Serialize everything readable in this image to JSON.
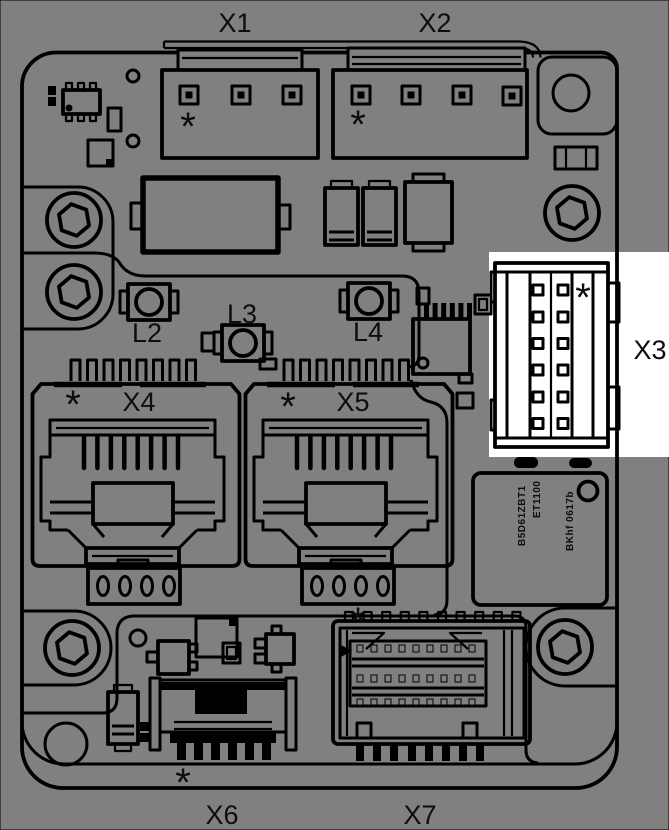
{
  "colors": {
    "background": "#808080",
    "ink": "#000000",
    "highlight_box": "#ffffff",
    "label_ink": "#0d0d0d"
  },
  "labels": {
    "x1": "X1",
    "x2": "X2",
    "x3": "X3",
    "x4": "X4",
    "x5": "X5",
    "x6": "X6",
    "x7": "X7",
    "l2": "L2",
    "l3": "L3",
    "l4": "L4"
  },
  "pin1_marker": "*",
  "chip_markings": {
    "line1": "B5D61ZBT1",
    "line2": "ET1100",
    "line3": "BKhf 0617b"
  }
}
